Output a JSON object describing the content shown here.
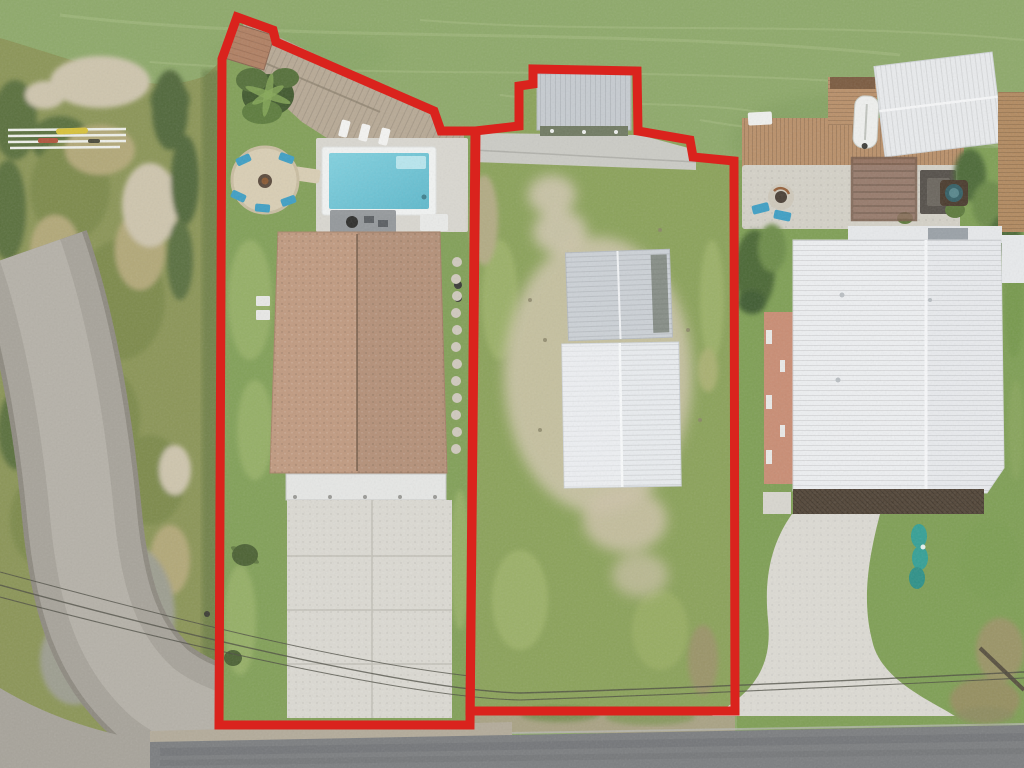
{
  "meta": {
    "type": "aerial-photograph",
    "alt": "Aerial drone view of two waterfront lots outlined in red: left lot with brown-roof house, pool, wood deck and concrete driveway; right vacant lot with boathouse and two white metal buildings; green canal water at top, salt marsh and dirt road at left, neighboring white metal-roof house with dock and curved driveway at right, asphalt street at bottom."
  },
  "palette": {
    "water": "#8ea96a",
    "waterStreak": "#a9bf85",
    "waterDark": "#7e9b5c",
    "marsh": "#8b9557",
    "marshDark": "#5a6f3e",
    "marshMid": "#7d8a4c",
    "marshTan": "#b2a878",
    "sand": "#cec5ad",
    "deadGrass": "#9d9e90",
    "lawn": "#82a058",
    "lawnLight": "#95af66",
    "bush": "#4c6234",
    "deckWood": "#b7a995",
    "poolPad": "#d9d7d0",
    "coping": "#f1f3f2",
    "poolA": "#82d1df",
    "poolB": "#5fb9cc",
    "poolLedge": "#b8e6ee",
    "firepit": "#d9ceb4",
    "chairBlue": "#3f9fc4",
    "roof": "#c09a80",
    "roofRidge": "#8a6e59",
    "porch": "#e6e7e5",
    "concrete": "#dbd9d2",
    "joint": "#c2c0b7",
    "metalA": "#ccd1d6",
    "metalB": "#e9ecef",
    "boathouse": "#c6cbd0",
    "dock": "#b9906a",
    "dockDark": "#7b5b40",
    "canopy": "#e9ebed",
    "paver": "#d4d1c7",
    "pergola": "#8f7060",
    "tableDark": "#55504a",
    "salmon": "#c98d74",
    "bigRoof": "#edeff1",
    "deckBand": "#55483a",
    "asphalt": "#7c7e80",
    "gravel": "#b3ab9a",
    "dirtRoad": "#a7a39a",
    "wire": "#4a4a40",
    "red": "#da231d",
    "teal": "#35a096",
    "boat": "#eff0ee",
    "brick": "#b08063"
  },
  "boundaries": {
    "stroke_width": 9,
    "lot1": {
      "points": "237,17 273,30 276,42 434,111 441,131 476,131 470,725 219,725 222,59"
    },
    "lot2": {
      "points": "519,126 519,86 533,84 533,69 637,71 638,131 690,140 693,157 734,161 735,711 470,711 475,131"
    }
  },
  "features": [
    "water-channel",
    "salt-marsh",
    "kayak-rack",
    "dirt-road",
    "lot1-pool-home",
    "pool",
    "spa-patio",
    "fire-pit-circle",
    "wood-deck",
    "brick-shed-roof",
    "main-house-roof",
    "covered-porch",
    "concrete-driveway",
    "lot2-vacant",
    "boathouse",
    "metal-building-upper",
    "metal-building-lower",
    "neighbor-dock",
    "boat-lift-canopy",
    "pergola",
    "patio-fire-bowl",
    "neighbor-house-roof",
    "curved-driveway",
    "street",
    "power-lines"
  ]
}
